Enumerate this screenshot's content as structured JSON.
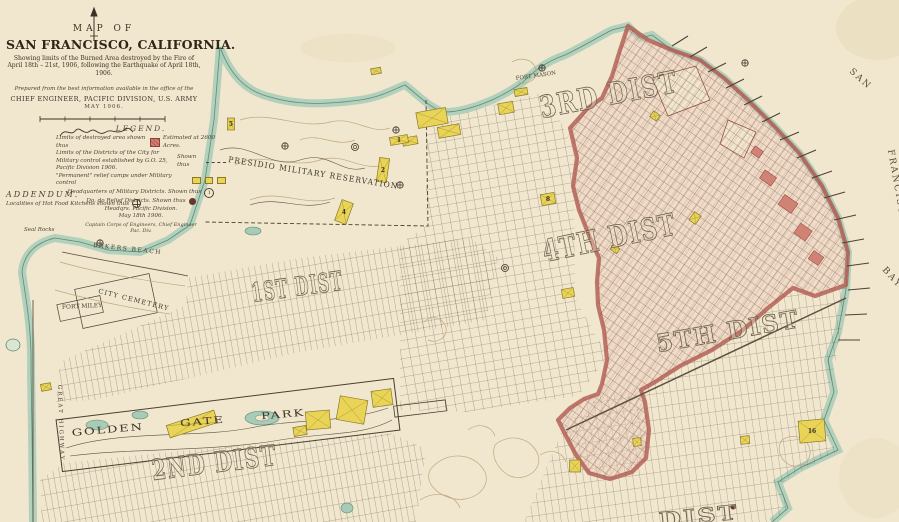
{
  "title_block": {
    "map_of": "MAP OF",
    "title": "SAN FRANCISCO, CALIFORNIA.",
    "subtitle1": "Showing limits of the Burned Area destroyed by the Fire of",
    "subtitle2": "April 18th – 21st, 1906, following the Earthquake of April 18th, 1906.",
    "prepared": "Prepared from the best information available in the office of the",
    "office": "CHIEF ENGINEER, PACIFIC DIVISION, U.S. ARMY",
    "date": "MAY 1906."
  },
  "legend": {
    "heading": "LEGEND.",
    "destroyed_label": "Limits of destroyed area shown thus",
    "destroyed_note": "Estimated at 2600 Acres.",
    "districts_label": "Limits of the Districts of the City for Military control established by G.O. 25, Pacific Division 1906.",
    "districts_shown": "Shown thus",
    "camps_label": "\"Permanent\" relief camps under Military control",
    "hq_military_label": "Headquarters of Military Districts.  Shown thus",
    "hq_military_symbol": "1",
    "hq_relief_label": "Do.   do   Relief Districts.   Shown thus",
    "hq_division": "Headqrs. Pacific Division.",
    "date": "May 18th 1906.",
    "signer_title": "Captain Corps of Engineers, Chief Engineer",
    "signer_division": "Pac. Div."
  },
  "addendum": {
    "heading": "ADDENDUM.",
    "text": "Localities of Hot Food Kitchens shown thus"
  },
  "districts": {
    "d1": "1ST DIST",
    "d2": "2ND DIST",
    "d3": "3RD DIST",
    "d4": "4TH DIST",
    "d5": "5TH DIST",
    "d6_partial": "DIST"
  },
  "places": {
    "presidio": "PRESIDIO MILITARY RESERVATION",
    "golden_gate_park": "GOLDEN GATE PARK",
    "city_cemetery": "CITY CEMETERY",
    "fort_miley": "FORT MILEY",
    "fort_mason": "FORT MASON",
    "bakers_beach": "BAKERS BEACH",
    "seal_rocks": "Seal Rocks",
    "great_highway": "GREAT HIGHWAY"
  },
  "water": {
    "san": "SAN",
    "francisco": "FRANCISCO",
    "bay": "BAY"
  },
  "colors": {
    "paper": "#f1e7cf",
    "ink": "#4e4234",
    "shore_teal": "#a7cbb7",
    "burned_red": "#b05a50",
    "camp_yellow": "#e9d457"
  },
  "features": {
    "camps": [
      {
        "x": 432,
        "y": 118,
        "w": 30,
        "h": 16,
        "r": -10
      },
      {
        "x": 449,
        "y": 131,
        "w": 22,
        "h": 11,
        "r": -10
      },
      {
        "x": 410,
        "y": 141,
        "w": 15,
        "h": 8,
        "r": -10
      },
      {
        "x": 506,
        "y": 108,
        "w": 15,
        "h": 11,
        "r": -10
      },
      {
        "x": 521,
        "y": 92,
        "w": 13,
        "h": 7,
        "r": -10
      },
      {
        "x": 399,
        "y": 140,
        "w": 18,
        "h": 8,
        "r": -10,
        "label": "1"
      },
      {
        "x": 383,
        "y": 170,
        "w": 10,
        "h": 24,
        "r": 8,
        "label": "2"
      },
      {
        "x": 344,
        "y": 212,
        "w": 12,
        "h": 22,
        "r": 20,
        "label": "4"
      },
      {
        "x": 231,
        "y": 124,
        "w": 7,
        "h": 12,
        "r": 0,
        "label": "5"
      },
      {
        "x": 548,
        "y": 199,
        "w": 14,
        "h": 11,
        "r": -10,
        "label": "8"
      },
      {
        "x": 568,
        "y": 293,
        "w": 12,
        "h": 9,
        "r": -10
      },
      {
        "x": 695,
        "y": 218,
        "w": 8,
        "h": 10,
        "r": 35
      },
      {
        "x": 655,
        "y": 116,
        "w": 8,
        "h": 7,
        "r": 35
      },
      {
        "x": 615,
        "y": 249,
        "w": 8,
        "h": 6,
        "r": 35
      },
      {
        "x": 575,
        "y": 466,
        "w": 11,
        "h": 12,
        "r": 0
      },
      {
        "x": 812,
        "y": 431,
        "w": 26,
        "h": 22,
        "r": -5,
        "label": "16"
      },
      {
        "x": 745,
        "y": 440,
        "w": 9,
        "h": 8,
        "r": -5
      },
      {
        "x": 637,
        "y": 442,
        "w": 8,
        "h": 8,
        "r": -5
      },
      {
        "x": 376,
        "y": 71,
        "w": 10,
        "h": 6,
        "r": -10
      },
      {
        "x": 192,
        "y": 424,
        "w": 50,
        "h": 13,
        "r": -18
      },
      {
        "x": 318,
        "y": 420,
        "w": 24,
        "h": 18,
        "r": -5
      },
      {
        "x": 352,
        "y": 410,
        "w": 28,
        "h": 24,
        "r": 10
      },
      {
        "x": 382,
        "y": 398,
        "w": 20,
        "h": 16,
        "r": -8
      },
      {
        "x": 300,
        "y": 431,
        "w": 13,
        "h": 9,
        "r": -10
      },
      {
        "x": 46,
        "y": 387,
        "w": 10,
        "h": 7,
        "r": -10
      }
    ],
    "kitchens": [
      {
        "x": 285,
        "y": 146
      },
      {
        "x": 396,
        "y": 130
      },
      {
        "x": 400,
        "y": 185
      },
      {
        "x": 542,
        "y": 68
      },
      {
        "x": 745,
        "y": 63
      },
      {
        "x": 100,
        "y": 243
      }
    ],
    "hq_marks": [
      {
        "x": 355,
        "y": 147
      },
      {
        "x": 505,
        "y": 268
      }
    ],
    "relief_dots": [
      {
        "x": 733,
        "y": 507
      }
    ]
  }
}
